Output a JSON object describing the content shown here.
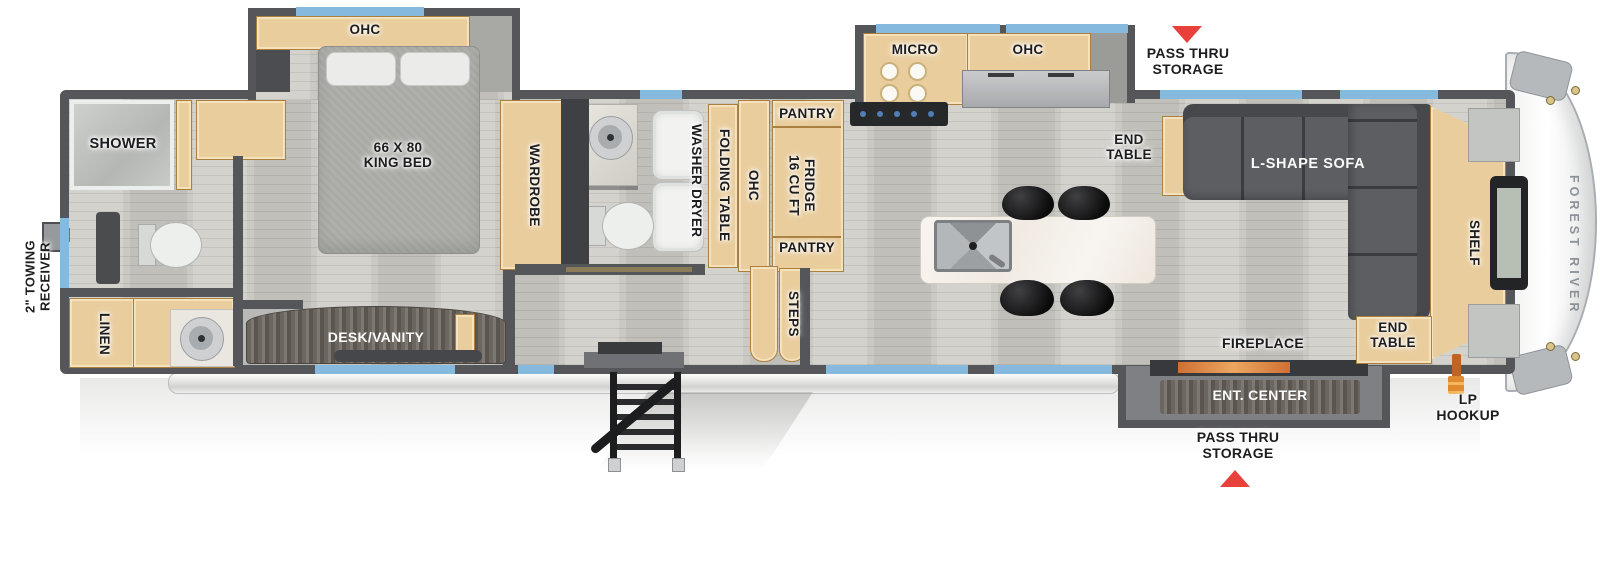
{
  "brand": "FOREST RIVER",
  "labels": {
    "towing_line1": "2\" TOWING",
    "towing_line2": "RECEIVER",
    "shower": "SHOWER",
    "linen": "LINEN",
    "ohc_bedroom": "OHC",
    "king_bed_line1": "66 X 80",
    "king_bed_line2": "KING BED",
    "desk_vanity": "DESK/VANITY",
    "wardrobe": "WARDROBE",
    "washer_dryer": "WASHER DRYER",
    "folding_table": "FOLDING TABLE",
    "ohc_bath": "OHC",
    "pantry_top": "PANTRY",
    "fridge_line1": "16 CU FT",
    "fridge_line2": "FRIDGE",
    "pantry_bottom": "PANTRY",
    "steps": "STEPS",
    "micro": "MICRO",
    "ohc_kitchen": "OHC",
    "pass_thru_line1": "PASS THRU",
    "pass_thru_line2": "STORAGE",
    "end_table_line1": "END",
    "end_table_line2": "TABLE",
    "l_shape_sofa": "L-SHAPE SOFA",
    "shelf": "SHELF",
    "fireplace": "FIREPLACE",
    "ent_center": "ENT. CENTER",
    "lp_line1": "LP",
    "lp_line2": "HOOKUP"
  },
  "colors": {
    "wall_gray": "#55565a",
    "window_blue": "#85b9de",
    "cabinet_tan": "#e9cd9d",
    "accent_red": "#e8413b",
    "sofa_gray": "#55575b",
    "floor": "#cbc9c4",
    "marble": "#f6f3ee",
    "dark_wood": "#6b6660",
    "brand_text": "#8a9197"
  }
}
